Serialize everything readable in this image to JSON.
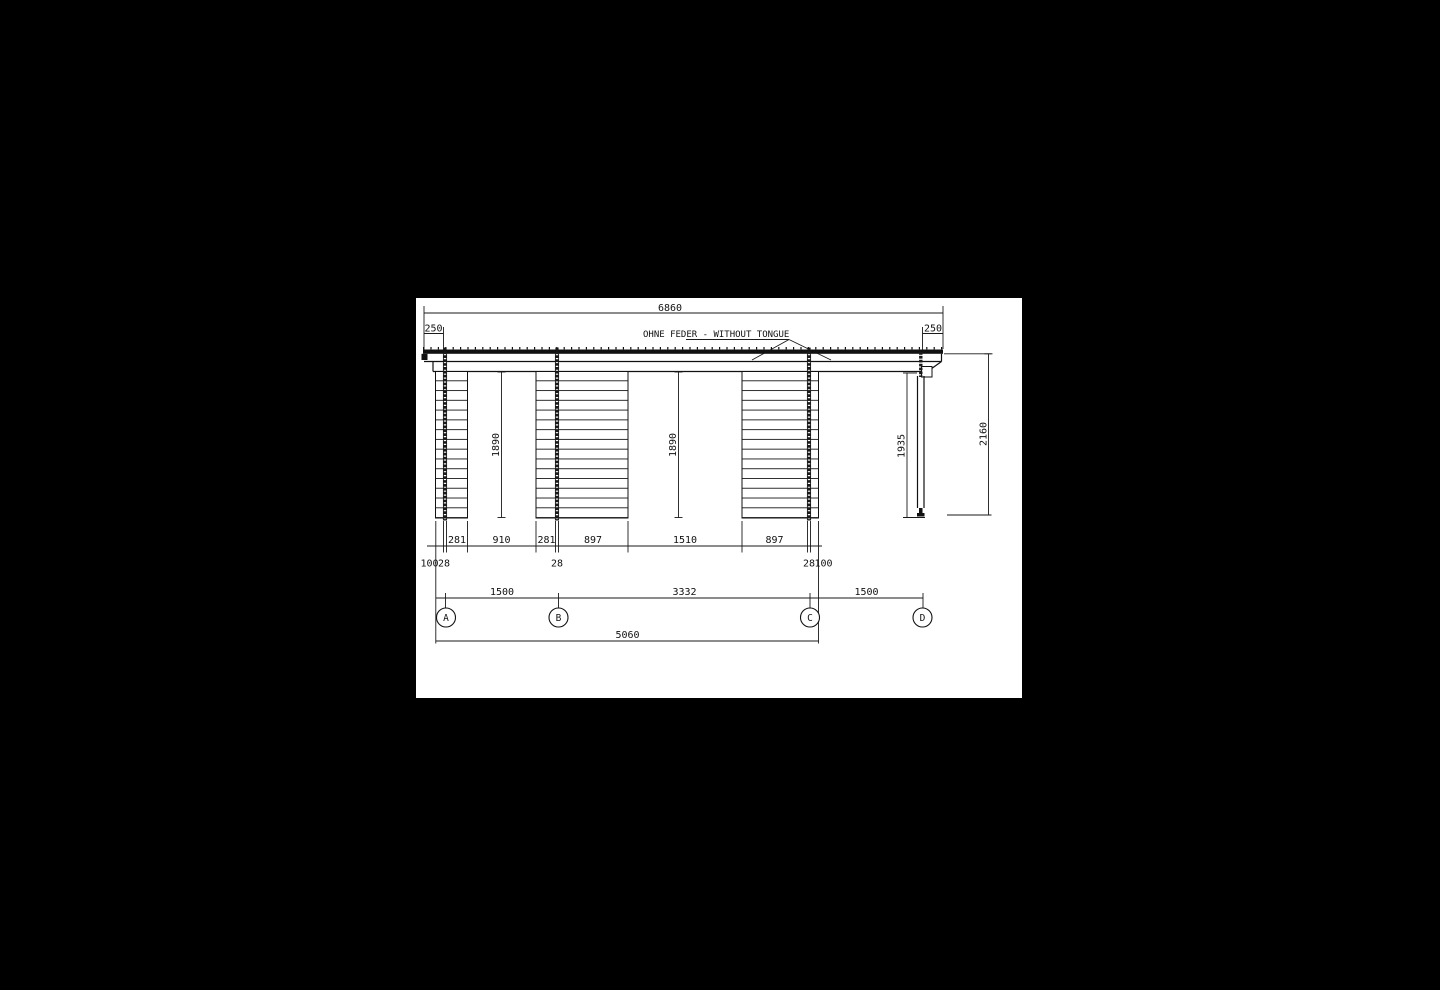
{
  "sheet": {
    "page_bg": "#000000",
    "paper_bg": "#ffffff",
    "ink": "#111111"
  },
  "note": {
    "prefix": "OHNE FEDER ",
    "underlined": "- WITHOUT TONGUE"
  },
  "dims": {
    "overall_width": "6860",
    "overhang_left": "250",
    "overhang_right": "250",
    "panel_height_left": "1890",
    "panel_height_mid": "1890",
    "post_height": "1935",
    "overall_height": "2160",
    "chain": [
      "281",
      "910",
      "281",
      "897",
      "1510",
      "897"
    ],
    "detail": [
      "100",
      "28",
      "28",
      "28",
      "100"
    ],
    "axis_spans": [
      "1500",
      "3332",
      "1500"
    ],
    "axis_overall": "5060"
  },
  "axes": {
    "labels": [
      "A",
      "B",
      "C",
      "D"
    ]
  }
}
